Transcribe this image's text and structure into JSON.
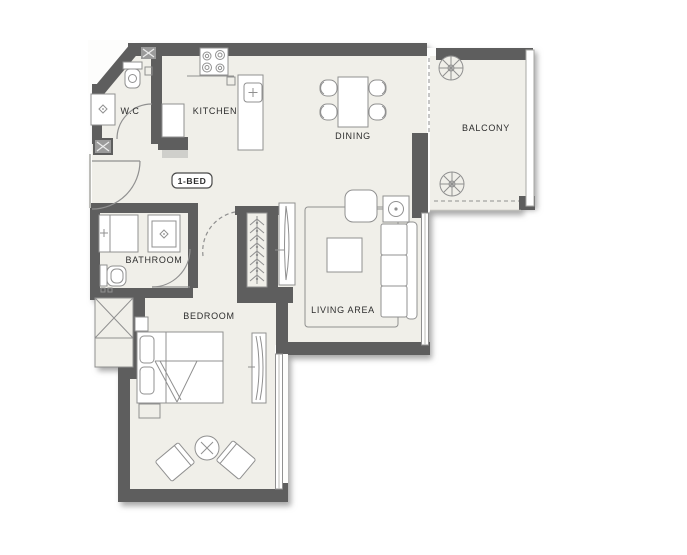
{
  "meta": {
    "drawing_type": "apartment floor plan",
    "unit_type": "1-BED"
  },
  "badge": {
    "label": "1-BED"
  },
  "rooms": {
    "wc": {
      "label": "W.C"
    },
    "kitchen": {
      "label": "KITCHEN"
    },
    "dining": {
      "label": "DINING"
    },
    "balcony": {
      "label": "BALCONY"
    },
    "bathroom": {
      "label": "BATHROOM"
    },
    "bedroom": {
      "label": "BEDROOM"
    },
    "living": {
      "label": "LIVING AREA"
    }
  },
  "colors": {
    "wall": "#5e5e5e",
    "floor": "#f0efe9",
    "line": "#909090",
    "faint": "#bdbdb9",
    "text": "#2d2d2d",
    "badge": "#4a4a4a",
    "bg": "#ffffff",
    "parapet": "#a8a8a5",
    "vent": "#9b9b9b"
  }
}
